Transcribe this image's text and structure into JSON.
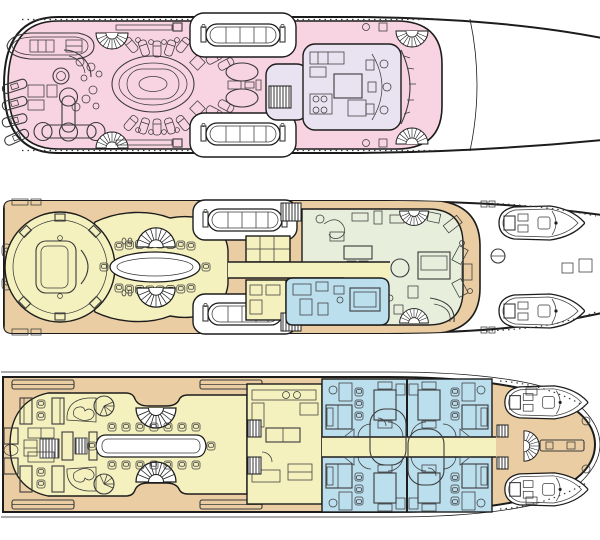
{
  "diagram": {
    "kind": "yacht-general-arrangement-plan",
    "orientation": "bow-right",
    "text_labels": [],
    "decks": [
      {
        "id": "sun-deck",
        "zone_colors": {
          "open-deck": "pink",
          "wheelhouse": "lavender",
          "foredeck": "white"
        },
        "features": [
          "stern-tender",
          "jet-skis",
          "deck-crane",
          "bar-counter",
          "cocktail-tables",
          "jacuzzi-pool",
          "sun-loungers",
          "fan-stairs",
          "port-lifeboat",
          "starboard-lifeboat",
          "gym-sunpads",
          "wheelhouse-consoles",
          "windshield",
          "open-foredeck"
        ]
      },
      {
        "id": "upper-deck",
        "zone_colors": {
          "side-decks": "tan",
          "skylounge": "yellow",
          "owners-stateroom": "green",
          "study": "blue",
          "foredeck": "white"
        },
        "features": [
          "aft-deck-settee",
          "circular-skylounge",
          "media-wall",
          "formal-dining-table",
          "fan-stairs",
          "port-lifeboat",
          "starboard-lifeboat",
          "pantry",
          "companionway-stairs",
          "corridor",
          "owners-furniture",
          "study-desk",
          "twin-tenders",
          "capstan",
          "deck-hatches"
        ]
      },
      {
        "id": "main-deck",
        "zone_colors": {
          "side-decks": "tan",
          "salon": "yellow",
          "galley": "yellow",
          "guest-cabins": "blue",
          "bow-deck": "tan"
        },
        "features": [
          "salon-sofas",
          "tv-console",
          "piano",
          "love-seat-nooks",
          "spiral-stairs",
          "fan-stairs",
          "dining-table",
          "galley-counters",
          "companionway-stairs",
          "guest-cabin-1",
          "guest-cabin-2",
          "guest-cabin-3",
          "guest-cabin-4",
          "cabin-corridor",
          "ensuite-bathrooms",
          "twin-tenders",
          "bow-spiral-stair",
          "bow-crane",
          "skylight-hatches"
        ]
      }
    ]
  },
  "palette": {
    "paper": "#ffffff",
    "hullWhite": "#ffffff",
    "pink": "#f8d3e1",
    "lavender": "#e9e3f1",
    "tan": "#eacda2",
    "yellow": "#f4f1bf",
    "green": "#e7efdc",
    "blue": "#bcdfee",
    "line": "#1c1c1c",
    "furniture": "#3a3a3a"
  }
}
